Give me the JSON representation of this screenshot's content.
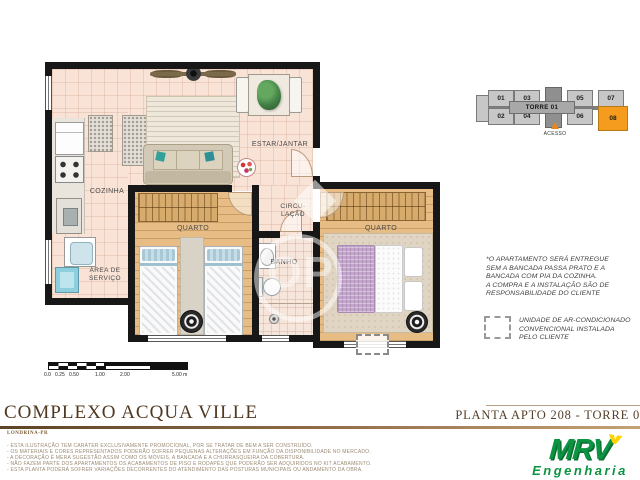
{
  "plan": {
    "labels": {
      "cozinha": "COZINHA",
      "estar_jantar": "ESTAR/JANTAR",
      "circulacao_1": "CIRCU-",
      "circulacao_2": "LAÇÃO",
      "banho": "BANHO",
      "area_servico_1": "ÁREA DE",
      "area_servico_2": "SERVIÇO",
      "quarto_1": "QUARTO",
      "quarto_2": "QUARTO"
    }
  },
  "key_plan": {
    "tower": "TORRE 01",
    "acesso": "ACESSO",
    "units": [
      "01",
      "02",
      "03",
      "04",
      "05",
      "06",
      "07",
      "08"
    ],
    "highlighted_unit": "08",
    "colors": {
      "highlight": "#F59B1E",
      "block": "#C7C7C7",
      "core": "#8F8F8F"
    }
  },
  "note": {
    "lines": [
      "*O APARTAMENTO SERÁ ENTREGUE",
      "SEM A BANCADA PASSA PRATO E A",
      "BANCADA COM PIA DA COZINHA.",
      "A COMPRA E A INSTALAÇÃO SÃO DE",
      "RESPONSABILIDADE DO CLIENTE"
    ]
  },
  "legend": {
    "ac_lines": [
      "UNIDADE DE AR-CONDICIONADO",
      "CONVENCIONAL INSTALADA",
      "PELO CLIENTE"
    ]
  },
  "scale_bar": {
    "labels": [
      "0.0",
      "0.25",
      "0.50",
      "1.00",
      "2.00",
      "5.00 m"
    ]
  },
  "title_block": {
    "project": "COMPLEXO ACQUA VILLE",
    "location": "LONDRINA-PR",
    "sheet": "PLANTA APTO 208 - TORRE 0"
  },
  "disclaimer": {
    "lines": [
      "- ESTA ILUSTRAÇÃO TEM CARÁTER EXCLUSIVAMENTE PROMOCIONAL, POR SE TRATAR DE BEM A SER CONSTRUÍDO.",
      "- OS MATERIAIS E CORES REPRESENTADOS PODERÃO SOFRER PEQUENAS ALTERAÇÕES EM FUNÇÃO DA DISPONIBILIDADE NO MERCADO.",
      "- A DECORAÇÃO É MERA SUGESTÃO ASSIM COMO OS MÓVEIS, A BANCADA E A CHURRASQUEIRA DA COBERTURA.",
      "- NÃO FAZEM PARTE DOS APARTAMENTOS OS ACABAMENTOS DE PISO E RODAPÉS QUE PODERÃO SER ADQUIRIDOS NO KIT ACABAMENTO.",
      "- ESTA PLANTA PODERÁ SOFRER VARIAÇÕES DECORRENTES DO ATENDIMENTO DAS POSTURAS MUNICIPAIS OU ANDAMENTO DA OBRA."
    ]
  },
  "brand": {
    "name": "MRV",
    "tagline": "Engenharia",
    "green": "#0D9442",
    "yellow": "#FFD200"
  },
  "watermark": {
    "text": "OP"
  }
}
